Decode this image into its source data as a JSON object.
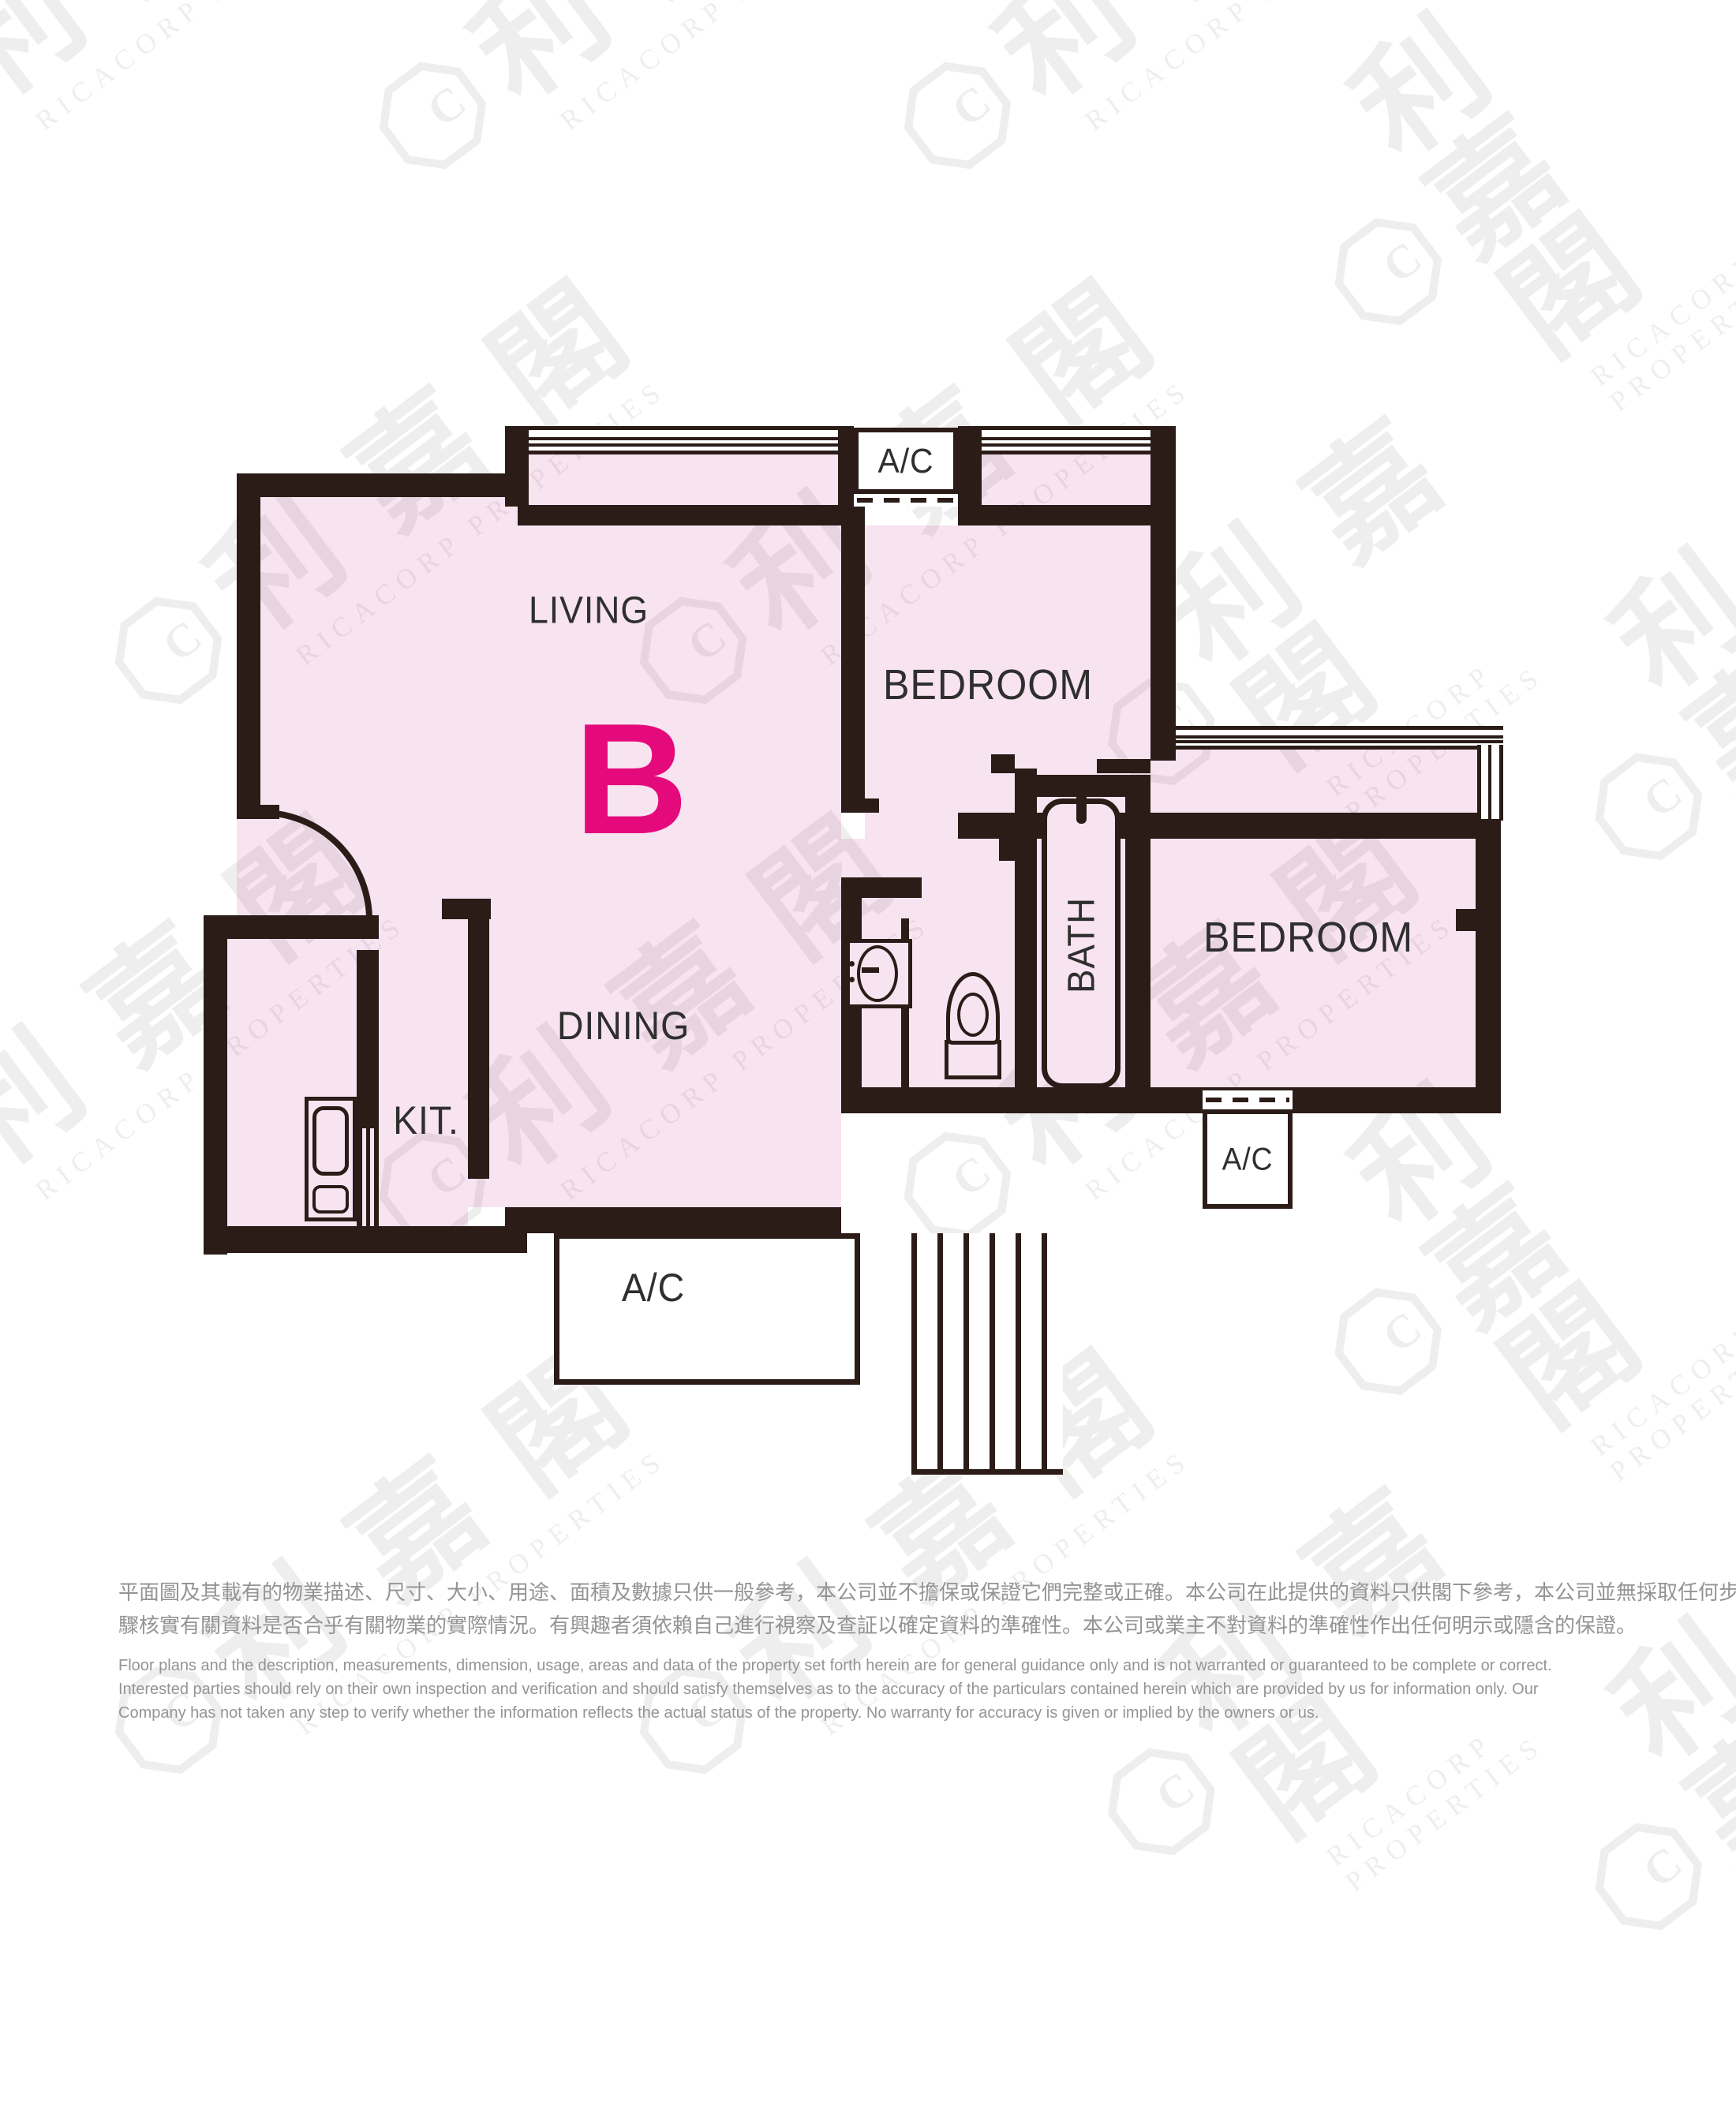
{
  "floor_plan": {
    "unit_letter": "B",
    "rooms": {
      "living": "LIVING",
      "bedroom_top": "BEDROOM",
      "bedroom_right": "BEDROOM",
      "dining": "DINING",
      "kitchen": "KIT.",
      "bath": "BATH"
    },
    "ac_labels": {
      "top": "A/C",
      "bottom": "A/C",
      "right": "A/C"
    }
  },
  "watermark": {
    "cjk": "利嘉閣",
    "latin": "RICACORP PROPERTIES"
  },
  "colors": {
    "wall": "#2b1c18",
    "floor_pink": "#f8e3f0",
    "unit_accent": "#e40a7c",
    "room_label": "#2f2f2f",
    "watermark_gray": "#ebebeb",
    "disclaimer_gray": "#949494",
    "background": "#ffffff"
  },
  "disclaimer": {
    "zh": [
      "平面圖及其載有的物業描述、尺寸、大小、用途、面積及數據只供一般參考，本公司並不擔保或保證它們完整或正確。本公司在此提供的資料只供閣下參考，本公司並無採取任何步",
      "驟核實有關資料是否合乎有關物業的實際情況。有興趣者須依賴自己進行視察及查証以確定資料的準確性。本公司或業主不對資料的準確性作出任何明示或隱含的保證。"
    ],
    "en": [
      "Floor plans and the description, measurements, dimension, usage, areas and data of the property set forth herein are for general guidance only and is not warranted or guaranteed to be complete or correct.",
      "Interested parties should rely on their own inspection and verification and should satisfy themselves as to the accuracy of the particulars contained herein which are provided by us for information only.  Our",
      "Company has not taken any step to verify whether the information reflects the actual status of the property.  No warranty for accuracy is given or implied by the owners or us."
    ]
  }
}
